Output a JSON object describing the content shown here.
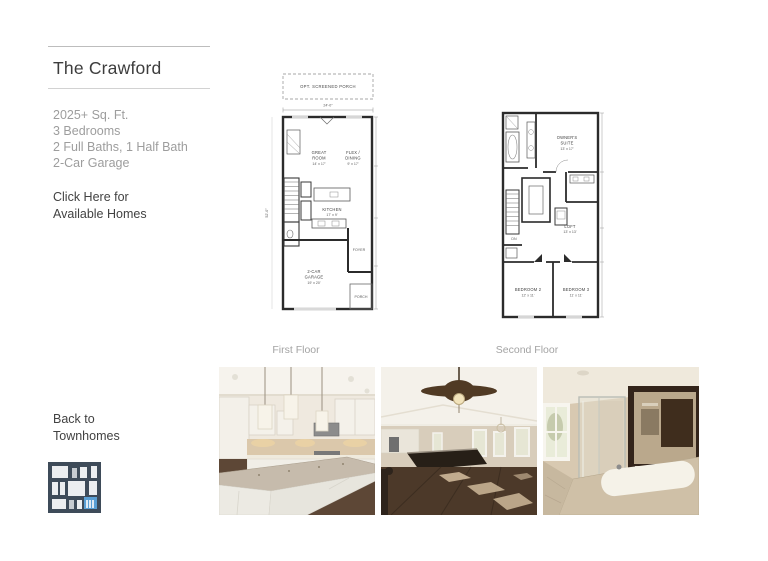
{
  "sidebar": {
    "title": "The Crawford",
    "specs": [
      "2025+ Sq. Ft.",
      "3 Bedrooms",
      "2 Full Baths, 1 Half Bath",
      "2-Car Garage"
    ],
    "available_line1": "Click Here for",
    "available_line2": "Available Homes",
    "back_line1": "Back to",
    "back_line2": "Townhomes"
  },
  "floorplan_first": {
    "caption": "First Floor",
    "porch": "OPT. SCREENED PORCH",
    "width_dim": "24'-0\"",
    "depth_dim": "52'-0\"",
    "great_room_1": "GREAT",
    "great_room_2": "ROOM",
    "great_room_dim": "14' x 17'",
    "flex_1": "FLEX /",
    "flex_2": "DINING",
    "flex_dim": "9' x 17'",
    "kitchen": "KITCHEN",
    "kitchen_dim": "17' x 9'",
    "garage_1": "2-CAR",
    "garage_2": "GARAGE",
    "garage_dim": "19' x 20'",
    "foyer": "FOYER",
    "porch_small": "PORCH"
  },
  "floorplan_second": {
    "caption": "Second Floor",
    "owners_1": "OWNER'S",
    "owners_2": "SUITE",
    "owners_dim": "13' x 17'",
    "loft": "LOFT",
    "loft_dim": "13' x 13'",
    "bedroom2": "BEDROOM 2",
    "bedroom2_dim": "12' x 11'",
    "bedroom3": "BEDROOM 3",
    "bedroom3_dim": "11' x 11'",
    "dn": "DN"
  },
  "photos": {
    "kitchen_alt": "kitchen with island",
    "living_alt": "great room with ceiling fan",
    "bath_alt": "owner's bath"
  },
  "colors": {
    "accent_blue": "#5a9fd4",
    "icon_navy": "#3e4b59",
    "text_dark": "#3d3d3d",
    "text_gray": "#9d9d9d",
    "plan_line": "#2b2b2b"
  }
}
